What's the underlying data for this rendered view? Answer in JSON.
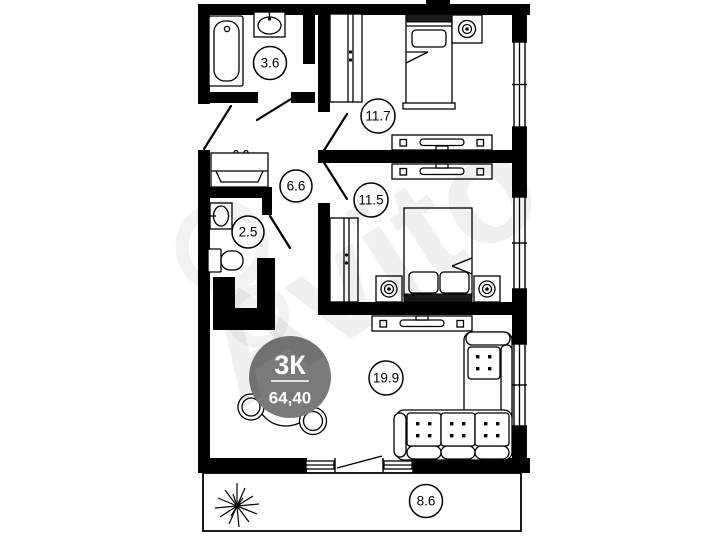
{
  "floorplan": {
    "watermark_text": "Avito",
    "badge": {
      "rooms": "3К",
      "area": "64,40",
      "bg": "#7a7a7a",
      "text_color": "#ffffff"
    },
    "labels": {
      "bathroom": "3.6",
      "bedroom1": "11.7",
      "hallway": "6.6",
      "wc": "2.5",
      "bedroom2": "11.5",
      "living": "19.9",
      "balcony": "8.6"
    },
    "colors": {
      "wall": "#000000",
      "background": "#ffffff",
      "line": "#000000",
      "watermark": "#000000"
    }
  }
}
